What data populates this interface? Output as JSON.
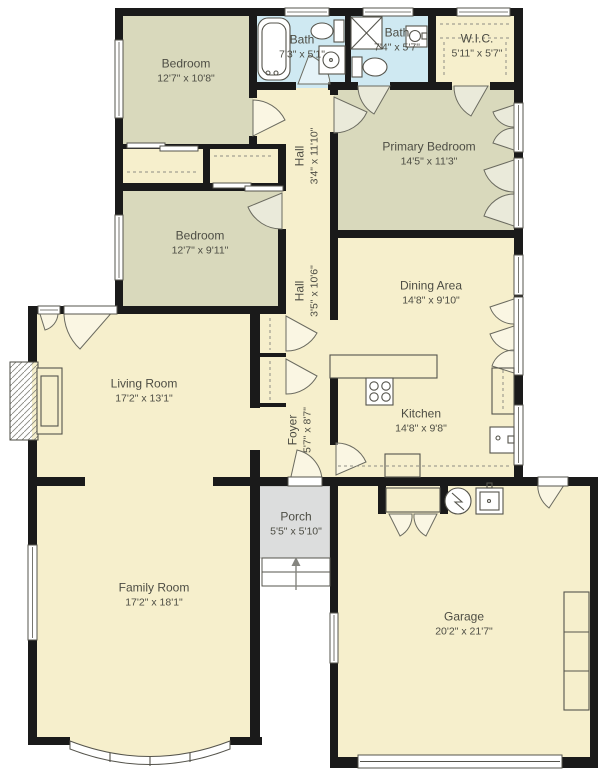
{
  "title": "Single-story house floor plan",
  "colors": {
    "wall": "#1a1a1a",
    "cream": "#f6efcc",
    "olive": "#d9d9bc",
    "bath": "#cfe9f2",
    "porch": "#dcdddd",
    "label": "#4d4d44",
    "fixture": "#55544c",
    "door": "#6b6b60"
  },
  "rooms": [
    {
      "name": "Bedroom",
      "dims": "12'7\" x 10'8\""
    },
    {
      "name": "Bath",
      "dims": "7'3\" x 5'1\""
    },
    {
      "name": "Bath",
      "dims": "7'4\" x 5'7\""
    },
    {
      "name": "W.I.C.",
      "dims": "5'11\" x 5'7\""
    },
    {
      "name": "Hall",
      "dims": "3'4\" x 11'10\""
    },
    {
      "name": "Primary Bedroom",
      "dims": "14'5\" x 11'3\""
    },
    {
      "name": "Bedroom",
      "dims": "12'7\" x 9'11\""
    },
    {
      "name": "Hall",
      "dims": "3'5\" x 10'6\""
    },
    {
      "name": "Dining Area",
      "dims": "14'8\" x 9'10\""
    },
    {
      "name": "Living Room",
      "dims": "17'2\" x 13'1\""
    },
    {
      "name": "Kitchen",
      "dims": "14'8\" x 9'8\""
    },
    {
      "name": "Foyer",
      "dims": "5'7\" x 8'7\""
    },
    {
      "name": "Porch",
      "dims": "5'5\" x 5'10\""
    },
    {
      "name": "Family Room",
      "dims": "17'2\" x 18'1\""
    },
    {
      "name": "Garage",
      "dims": "20'2\" x 21'7\""
    }
  ],
  "fixtures": [
    "bathtub",
    "toilet",
    "sink",
    "shower",
    "closet-rod",
    "sliding-closet-doors",
    "stove",
    "kitchen-sink",
    "pantry",
    "dishwasher",
    "fireplace",
    "water-heater",
    "utility-sink",
    "storage-shelves",
    "bay-window",
    "entry-steps",
    "entry-arrow",
    "garage-door"
  ]
}
